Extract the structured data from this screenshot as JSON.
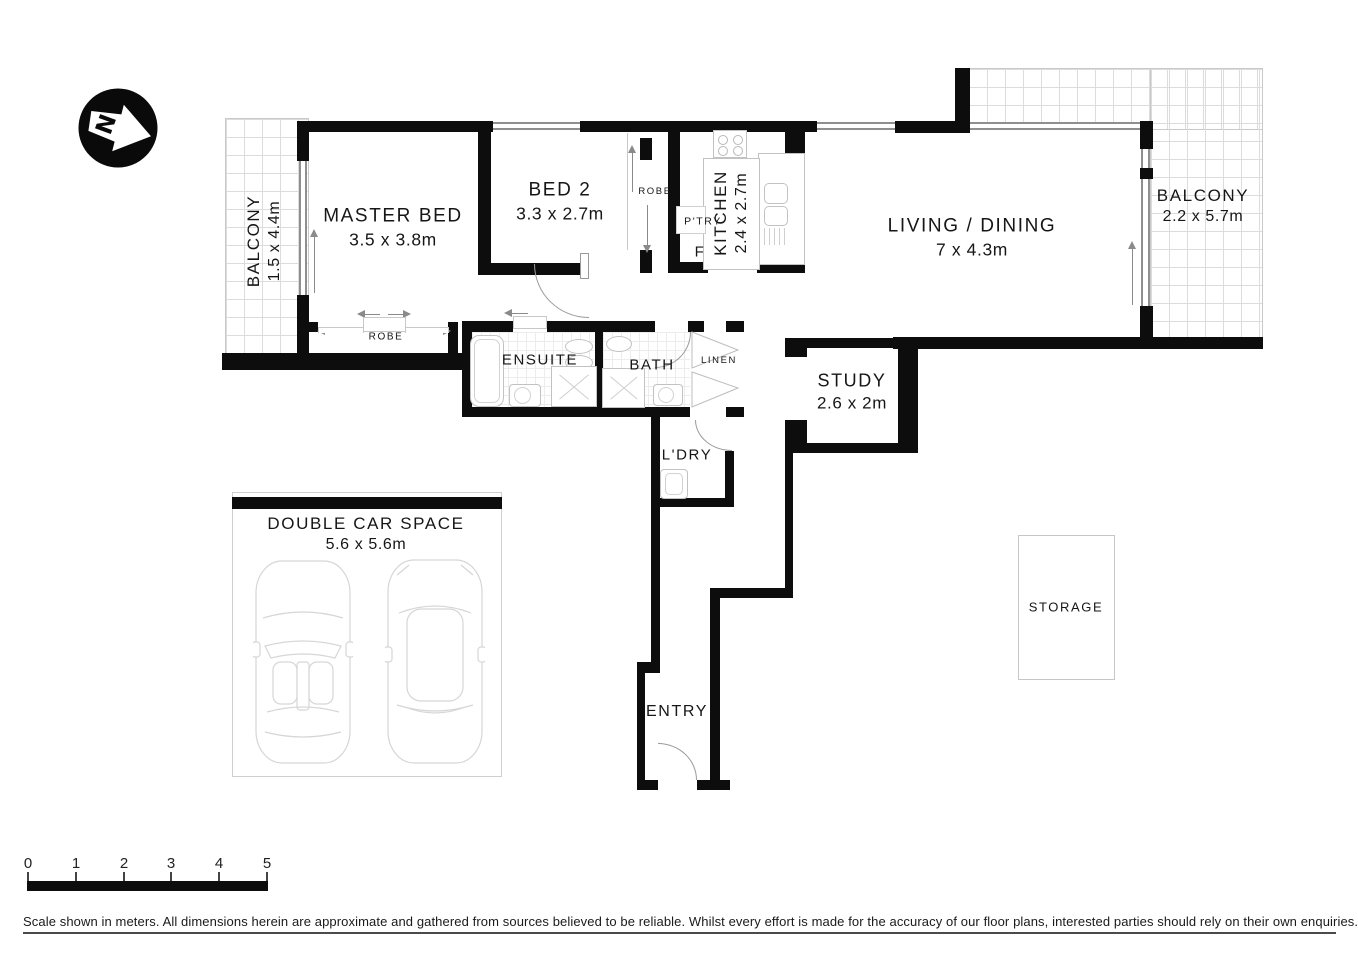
{
  "compass": {
    "label": "N"
  },
  "rooms": {
    "balcony_left": {
      "name": "BALCONY",
      "dims": "1.5 x 4.4m"
    },
    "master_bed": {
      "name": "MASTER BED",
      "dims": "3.5 x 3.8m"
    },
    "bed2": {
      "name": "BED 2",
      "dims": "3.3 x 2.7m"
    },
    "robe_bed2": {
      "name": "ROBE"
    },
    "robe_master": {
      "name": "ROBE"
    },
    "pantry": {
      "name": "P'TRY"
    },
    "fridge": {
      "name": "F"
    },
    "kitchen": {
      "name": "KITCHEN",
      "dims": "2.4 x 2.7m"
    },
    "living_dining": {
      "name": "LIVING / DINING",
      "dims": "7 x 4.3m"
    },
    "balcony_right": {
      "name": "BALCONY",
      "dims": "2.2 x 5.7m"
    },
    "ensuite": {
      "name": "ENSUITE"
    },
    "bath": {
      "name": "BATH"
    },
    "linen": {
      "name": "LINEN"
    },
    "study": {
      "name": "STUDY",
      "dims": "2.6 x 2m"
    },
    "laundry": {
      "name": "L'DRY"
    },
    "entry": {
      "name": "ENTRY"
    },
    "storage": {
      "name": "STORAGE"
    },
    "car_space": {
      "name": "DOUBLE CAR SPACE",
      "dims": "5.6 x 5.6m"
    }
  },
  "scale_bar": {
    "labels": [
      "0",
      "1",
      "2",
      "3",
      "4",
      "5"
    ]
  },
  "disclaimer": "Scale shown in meters. All dimensions herein are approximate and gathered from sources believed to be  reliable. Whilst every effort is made for the accuracy of our floor plans, interested parties should rely on their own enquiries.",
  "colors": {
    "wall": "#0d0d0d",
    "fixture_line": "#c2c2c2",
    "grid_line": "#dcdcdc"
  }
}
